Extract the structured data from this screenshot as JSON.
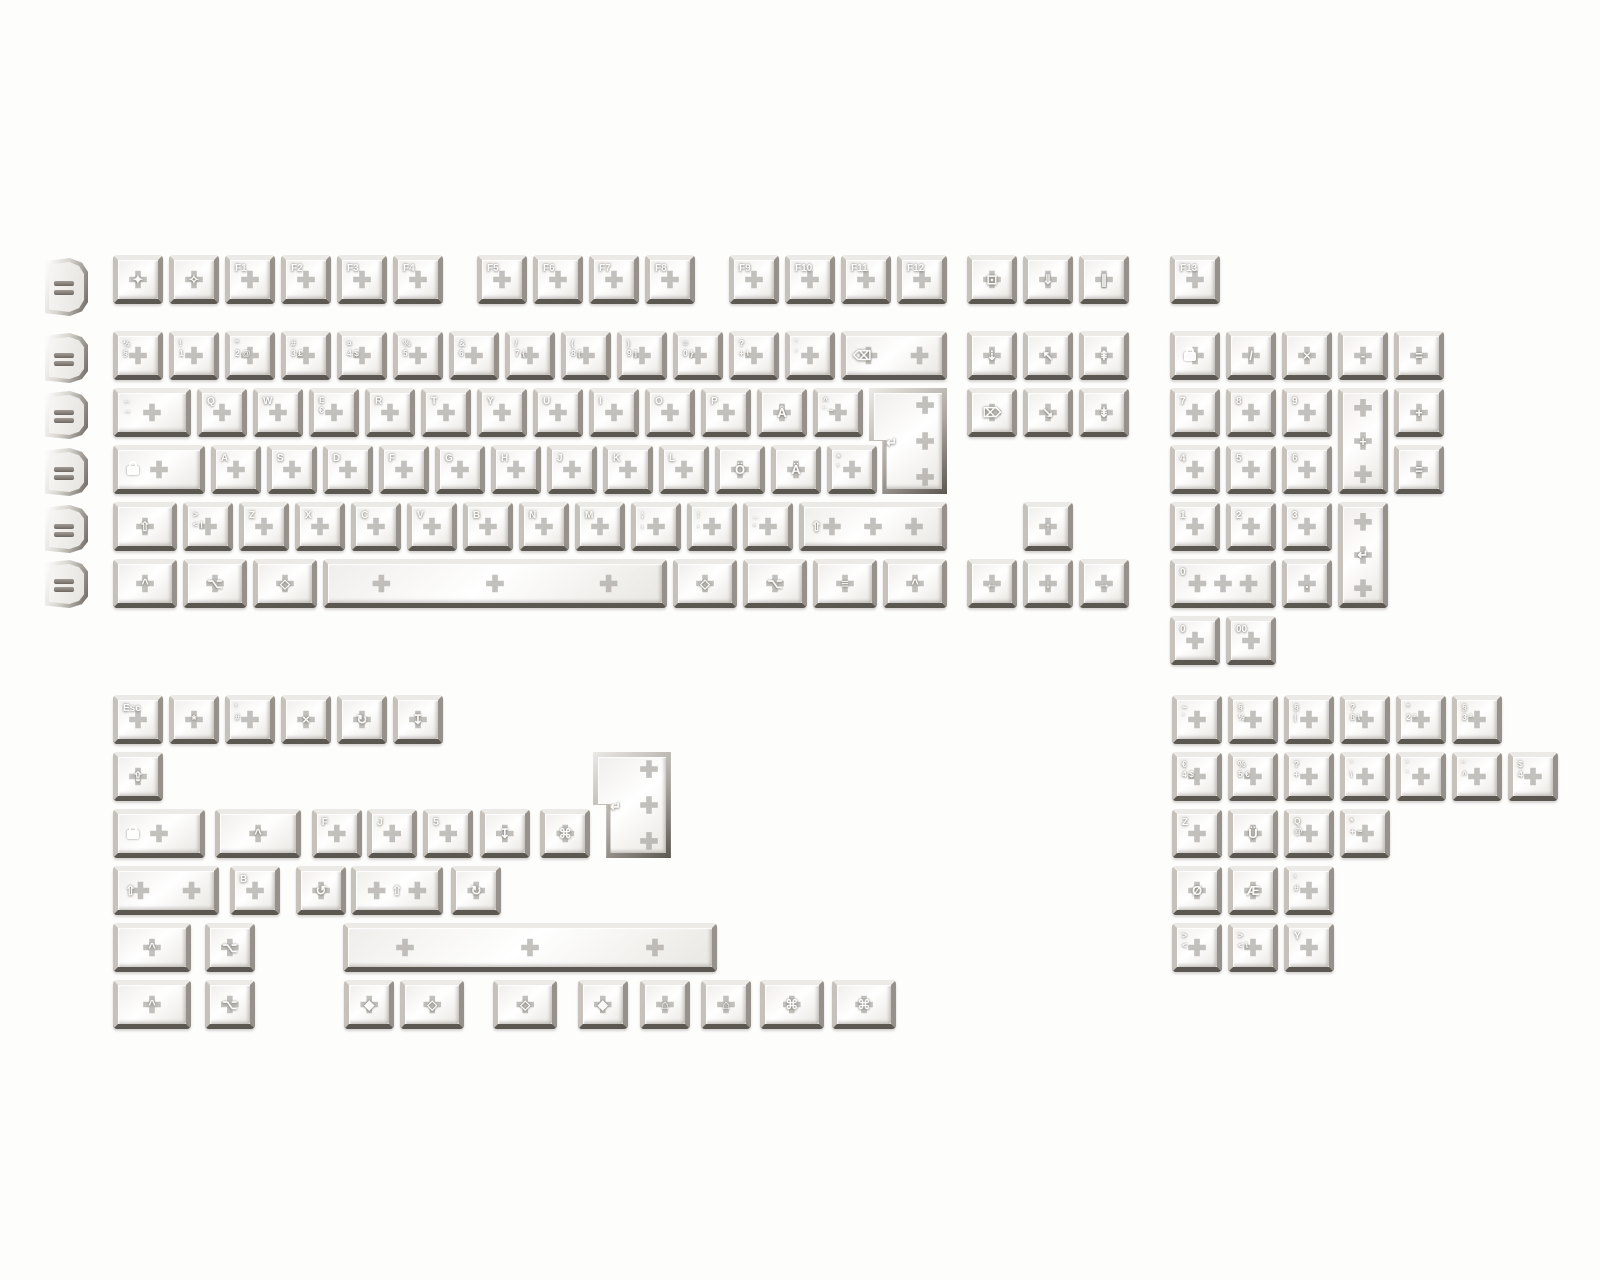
{
  "image": {
    "kind": "keycap-set-product-photo",
    "width": 1600,
    "height": 1280
  },
  "colors": {
    "background": "#fdfdfc",
    "frame_light": "#eceae6",
    "frame_dark": "#5b5751",
    "face": "#ffffff",
    "stem": "#706b64",
    "legend": "#ffffff"
  },
  "unit": 56,
  "row_height": 57,
  "profiles": {
    "name": "keycap-profile-column",
    "x": 45,
    "items": [
      {
        "y": 258,
        "h": 58
      },
      {
        "y": 333,
        "h": 50
      },
      {
        "y": 391,
        "h": 48
      },
      {
        "y": 448,
        "h": 48
      },
      {
        "y": 505,
        "h": 48
      },
      {
        "y": 560,
        "h": 48
      }
    ]
  },
  "blocks": [
    {
      "name": "main-keyboard",
      "x": 113,
      "y": 255,
      "keys": [
        {
          "x": 0,
          "y": 0,
          "l": "✦",
          "n": "esc"
        },
        {
          "x": 1,
          "y": 0,
          "l": "✧",
          "n": "esc-alt"
        },
        {
          "x": 2,
          "y": 0,
          "l": "F1",
          "n": "f1"
        },
        {
          "x": 3,
          "y": 0,
          "l": "F2",
          "n": "f2"
        },
        {
          "x": 4,
          "y": 0,
          "l": "F3",
          "n": "f3"
        },
        {
          "x": 5,
          "y": 0,
          "l": "F4",
          "n": "f4"
        },
        {
          "x": 6.5,
          "y": 0,
          "l": "F5",
          "n": "f5"
        },
        {
          "x": 7.5,
          "y": 0,
          "l": "F6",
          "n": "f6"
        },
        {
          "x": 8.5,
          "y": 0,
          "l": "F7",
          "n": "f7"
        },
        {
          "x": 9.5,
          "y": 0,
          "l": "F8",
          "n": "f8"
        },
        {
          "x": 11,
          "y": 0,
          "l": "F9",
          "n": "f9"
        },
        {
          "x": 12,
          "y": 0,
          "l": "F10",
          "n": "f10"
        },
        {
          "x": 13,
          "y": 0,
          "l": "F11",
          "n": "f11"
        },
        {
          "x": 14,
          "y": 0,
          "l": "F12",
          "n": "f12"
        },
        {
          "x": 0,
          "y": 76,
          "l": "½\n§",
          "n": "half-section"
        },
        {
          "x": 1,
          "y": 76,
          "l": "!\n1",
          "n": "1"
        },
        {
          "x": 2,
          "y": 76,
          "l": "\"\n2 @",
          "n": "2"
        },
        {
          "x": 3,
          "y": 76,
          "l": "#\n3 £",
          "n": "3"
        },
        {
          "x": 4,
          "y": 76,
          "l": "¤\n4 $",
          "n": "4"
        },
        {
          "x": 5,
          "y": 76,
          "l": "%\n5",
          "n": "5"
        },
        {
          "x": 6,
          "y": 76,
          "l": "&\n6",
          "n": "6"
        },
        {
          "x": 7,
          "y": 76,
          "l": "/\n7 {",
          "n": "7"
        },
        {
          "x": 8,
          "y": 76,
          "l": "(\n8 [",
          "n": "8"
        },
        {
          "x": 9,
          "y": 76,
          "l": ")\n9 ]",
          "n": "9"
        },
        {
          "x": 10,
          "y": 76,
          "l": "=\n0 }",
          "n": "0"
        },
        {
          "x": 11,
          "y": 76,
          "l": "?\n+ \\",
          "n": "plus"
        },
        {
          "x": 12,
          "y": 76,
          "l": "`\n´",
          "n": "acute"
        },
        {
          "x": 13,
          "y": 76,
          "w": 2,
          "l": "⌫",
          "n": "backspace",
          "s": 2
        },
        {
          "x": 0,
          "y": 133,
          "w": 1.5,
          "l": "←\n→",
          "n": "tab"
        },
        {
          "x": 1.5,
          "y": 133,
          "l": "Q",
          "n": "q"
        },
        {
          "x": 2.5,
          "y": 133,
          "l": "W",
          "n": "w"
        },
        {
          "x": 3.5,
          "y": 133,
          "l": "E\n€",
          "n": "e"
        },
        {
          "x": 4.5,
          "y": 133,
          "l": "R",
          "n": "r"
        },
        {
          "x": 5.5,
          "y": 133,
          "l": "T",
          "n": "t"
        },
        {
          "x": 6.5,
          "y": 133,
          "l": "Y",
          "n": "y"
        },
        {
          "x": 7.5,
          "y": 133,
          "l": "U",
          "n": "u"
        },
        {
          "x": 8.5,
          "y": 133,
          "l": "I",
          "n": "i"
        },
        {
          "x": 9.5,
          "y": 133,
          "l": "O",
          "n": "o"
        },
        {
          "x": 10.5,
          "y": 133,
          "l": "P",
          "n": "p"
        },
        {
          "x": 11.5,
          "y": 133,
          "l": "Å",
          "n": "aring"
        },
        {
          "x": 12.5,
          "y": 133,
          "l": "^\n¨ ~",
          "n": "diaeresis"
        },
        {
          "x": 13.5,
          "y": 133,
          "w": 1.5,
          "h": 2,
          "l": "↵",
          "n": "iso-enter",
          "shape": "iso",
          "s": 3
        },
        {
          "x": 0,
          "y": 190,
          "w": 1.75,
          "l": "{lock}",
          "n": "caps-lock"
        },
        {
          "x": 1.75,
          "y": 190,
          "l": "A",
          "n": "a"
        },
        {
          "x": 2.75,
          "y": 190,
          "l": "S",
          "n": "s"
        },
        {
          "x": 3.75,
          "y": 190,
          "l": "D",
          "n": "d"
        },
        {
          "x": 4.75,
          "y": 190,
          "l": "F",
          "n": "f"
        },
        {
          "x": 5.75,
          "y": 190,
          "l": "G",
          "n": "g"
        },
        {
          "x": 6.75,
          "y": 190,
          "l": "H",
          "n": "h"
        },
        {
          "x": 7.75,
          "y": 190,
          "l": "J",
          "n": "j"
        },
        {
          "x": 8.75,
          "y": 190,
          "l": "K",
          "n": "k"
        },
        {
          "x": 9.75,
          "y": 190,
          "l": "L",
          "n": "l"
        },
        {
          "x": 10.75,
          "y": 190,
          "l": "Ö",
          "n": "odiaeresis"
        },
        {
          "x": 11.75,
          "y": 190,
          "l": "Ä",
          "n": "adiaeresis"
        },
        {
          "x": 12.75,
          "y": 190,
          "l": "*\n'",
          "n": "apostrophe"
        },
        {
          "x": 0,
          "y": 247,
          "w": 1.25,
          "l": "⇧",
          "n": "shift-left"
        },
        {
          "x": 1.25,
          "y": 247,
          "l": ">\n< |",
          "n": "less-greater"
        },
        {
          "x": 2.25,
          "y": 247,
          "l": "Z",
          "n": "z"
        },
        {
          "x": 3.25,
          "y": 247,
          "l": "X",
          "n": "x"
        },
        {
          "x": 4.25,
          "y": 247,
          "l": "C",
          "n": "c"
        },
        {
          "x": 5.25,
          "y": 247,
          "l": "V",
          "n": "v"
        },
        {
          "x": 6.25,
          "y": 247,
          "l": "B",
          "n": "b"
        },
        {
          "x": 7.25,
          "y": 247,
          "l": "N",
          "n": "n"
        },
        {
          "x": 8.25,
          "y": 247,
          "l": "M",
          "n": "m"
        },
        {
          "x": 9.25,
          "y": 247,
          "l": ";\n,",
          "n": "comma"
        },
        {
          "x": 10.25,
          "y": 247,
          "l": ":\n.",
          "n": "period"
        },
        {
          "x": 11.25,
          "y": 247,
          "l": "_\n-",
          "n": "minus"
        },
        {
          "x": 12.25,
          "y": 247,
          "w": 2.75,
          "l": "⇧",
          "n": "shift-right",
          "s": 3
        },
        {
          "x": 0,
          "y": 304,
          "w": 1.25,
          "l": "^",
          "n": "ctrl-left"
        },
        {
          "x": 1.25,
          "y": 304,
          "w": 1.25,
          "l": "⌥",
          "n": "win-left"
        },
        {
          "x": 2.5,
          "y": 304,
          "w": 1.25,
          "l": "◇",
          "n": "alt-left"
        },
        {
          "x": 3.75,
          "y": 304,
          "w": 6.25,
          "l": "",
          "n": "spacebar",
          "s": 3
        },
        {
          "x": 10,
          "y": 304,
          "w": 1.25,
          "l": "◇",
          "n": "alt-right"
        },
        {
          "x": 11.25,
          "y": 304,
          "w": 1.25,
          "l": "⌥",
          "n": "fn"
        },
        {
          "x": 12.5,
          "y": 304,
          "w": 1.25,
          "l": "≡",
          "n": "menu"
        },
        {
          "x": 13.75,
          "y": 304,
          "w": 1.25,
          "l": "^",
          "n": "ctrl-right"
        }
      ]
    },
    {
      "name": "nav-cluster",
      "x": 967,
      "y": 255,
      "keys": [
        {
          "x": 0,
          "y": 0,
          "l": "⊡",
          "n": "print-screen"
        },
        {
          "x": 1,
          "y": 0,
          "l": "⇓",
          "n": "scroll-lock"
        },
        {
          "x": 2,
          "y": 0,
          "l": "∥",
          "n": "pause"
        },
        {
          "x": 0,
          "y": 76,
          "l": "⇣",
          "n": "insert"
        },
        {
          "x": 1,
          "y": 76,
          "l": "↖",
          "n": "home"
        },
        {
          "x": 2,
          "y": 76,
          "l": "⇞",
          "n": "page-up"
        },
        {
          "x": 0,
          "y": 133,
          "l": "⌦",
          "n": "delete"
        },
        {
          "x": 1,
          "y": 133,
          "l": "↘",
          "n": "end"
        },
        {
          "x": 2,
          "y": 133,
          "l": "⇟",
          "n": "page-down"
        },
        {
          "x": 1,
          "y": 247,
          "l": "↑",
          "n": "arrow-up"
        },
        {
          "x": 0,
          "y": 304,
          "l": "←",
          "n": "arrow-left"
        },
        {
          "x": 1,
          "y": 304,
          "l": "↓",
          "n": "arrow-down"
        },
        {
          "x": 2,
          "y": 304,
          "l": "→",
          "n": "arrow-right"
        }
      ]
    },
    {
      "name": "numpad",
      "x": 1170,
      "y": 331,
      "keys": [
        {
          "x": 0,
          "y": -76,
          "l": "F13",
          "n": "f13"
        },
        {
          "x": 0,
          "y": 0,
          "l": "{lock}",
          "n": "num-lock"
        },
        {
          "x": 1,
          "y": 0,
          "l": "/",
          "n": "np-divide"
        },
        {
          "x": 2,
          "y": 0,
          "l": "×",
          "n": "np-multiply"
        },
        {
          "x": 3,
          "y": 0,
          "l": "-",
          "n": "np-minus"
        },
        {
          "x": 4,
          "y": 0,
          "l": "=",
          "n": "np-equals"
        },
        {
          "x": 0,
          "y": 57,
          "l": "7",
          "n": "np-7"
        },
        {
          "x": 1,
          "y": 57,
          "l": "8",
          "n": "np-8"
        },
        {
          "x": 2,
          "y": 57,
          "l": "9",
          "n": "np-9"
        },
        {
          "x": 3,
          "y": 57,
          "h": 2,
          "l": "+",
          "n": "np-plus",
          "s": 3
        },
        {
          "x": 4,
          "y": 57,
          "l": "+",
          "n": "np-plus-1u"
        },
        {
          "x": 0,
          "y": 114,
          "l": "4",
          "n": "np-4"
        },
        {
          "x": 1,
          "y": 114,
          "l": "5",
          "n": "np-5"
        },
        {
          "x": 2,
          "y": 114,
          "l": "6",
          "n": "np-6"
        },
        {
          "x": 4,
          "y": 114,
          "l": "=",
          "n": "np-equals-alt"
        },
        {
          "x": 0,
          "y": 171,
          "l": "1",
          "n": "np-1"
        },
        {
          "x": 1,
          "y": 171,
          "l": "2",
          "n": "np-2"
        },
        {
          "x": 2,
          "y": 171,
          "l": "3",
          "n": "np-3"
        },
        {
          "x": 3,
          "y": 171,
          "h": 2,
          "l": "↵",
          "n": "np-enter",
          "s": 3
        },
        {
          "x": 0,
          "y": 228,
          "w": 2,
          "l": "0",
          "n": "np-0",
          "s": 3
        },
        {
          "x": 2,
          "y": 228,
          "l": ".",
          "n": "np-period"
        },
        {
          "x": 0,
          "y": 285,
          "l": "0",
          "n": "np-0-1u"
        },
        {
          "x": 1,
          "y": 285,
          "l": "00",
          "n": "np-00"
        }
      ]
    },
    {
      "name": "extras-left",
      "x": 113,
      "y": 695,
      "keys": [
        {
          "x": 0,
          "y": 0,
          "l": "Esc",
          "n": "esc-text"
        },
        {
          "x": 1,
          "y": 0,
          "l": "*",
          "n": "asterisk-alt"
        },
        {
          "x": 2,
          "y": 0,
          "l": "'\n#",
          "n": "hash"
        },
        {
          "x": 3,
          "y": 0,
          "l": "×",
          "n": "multiply-alt"
        },
        {
          "x": 4,
          "y": 0,
          "l": "↻",
          "n": "cycle-cw"
        },
        {
          "x": 5,
          "y": 0,
          "l": "↧",
          "n": "eject"
        },
        {
          "x": 0,
          "y": 57,
          "l": "⇪",
          "n": "caps-arrow"
        },
        {
          "x": 0,
          "y": 114,
          "w": 1.75,
          "l": "{lock}",
          "n": "caps-lock-alt"
        },
        {
          "x": 1.82,
          "y": 114,
          "w": 1.65,
          "l": "^",
          "n": "ctrl-wide"
        },
        {
          "x": 3.55,
          "y": 114,
          "l": "F",
          "n": "f-homing"
        },
        {
          "x": 4.54,
          "y": 114,
          "l": "J",
          "n": "j-homing"
        },
        {
          "x": 5.54,
          "y": 114,
          "l": "5",
          "n": "5-homing"
        },
        {
          "x": 6.55,
          "y": 114,
          "l": "↧",
          "n": "eject-2"
        },
        {
          "x": 7.63,
          "y": 114,
          "l": "⌘",
          "n": "command-1u"
        },
        {
          "x": 8.57,
          "y": 57,
          "w": 1.5,
          "h": 2,
          "l": "↵",
          "n": "iso-enter-alt",
          "shape": "iso",
          "s": 3
        },
        {
          "x": 0,
          "y": 171,
          "w": 2,
          "l": "⇧",
          "n": "shift-2u",
          "s": 2
        },
        {
          "x": 2.09,
          "y": 171,
          "l": "B",
          "n": "b-alt"
        },
        {
          "x": 3.27,
          "y": 171,
          "l": "↺",
          "n": "cycle-ccw"
        },
        {
          "x": 4.25,
          "y": 171,
          "w": 1.75,
          "l": "⇧",
          "n": "shift-175",
          "s": 2
        },
        {
          "x": 6.04,
          "y": 171,
          "l": "↻",
          "n": "cycle-cw-2"
        },
        {
          "x": 0,
          "y": 228,
          "w": 1.5,
          "l": "^",
          "n": "ctrl-15a"
        },
        {
          "x": 1.64,
          "y": 228,
          "l": "⌥",
          "n": "opt-1ua"
        },
        {
          "x": 4.1,
          "y": 228,
          "w": 6.8,
          "l": "",
          "n": "spacebar-7u",
          "s": 3
        },
        {
          "x": 0,
          "y": 285,
          "w": 1.5,
          "l": "^",
          "n": "ctrl-15b"
        },
        {
          "x": 1.64,
          "y": 285,
          "l": "⌥",
          "n": "opt-1ub"
        },
        {
          "x": 4.13,
          "y": 285,
          "l": "◆",
          "n": "meta-1ua"
        },
        {
          "x": 5.13,
          "y": 285,
          "w": 1.25,
          "l": "◇",
          "n": "alt-125a"
        },
        {
          "x": 6.79,
          "y": 285,
          "w": 1.25,
          "l": "◇",
          "n": "alt-125b"
        },
        {
          "x": 8.3,
          "y": 285,
          "l": "◆",
          "n": "meta-1ub"
        },
        {
          "x": 9.41,
          "y": 285,
          "l": "⌂",
          "n": "os-home-a"
        },
        {
          "x": 10.5,
          "y": 285,
          "l": "⌂",
          "n": "os-home-b"
        },
        {
          "x": 11.55,
          "y": 285,
          "w": 1.25,
          "l": "⌘",
          "n": "command-125a"
        },
        {
          "x": 12.84,
          "y": 285,
          "w": 1.25,
          "l": "⌘",
          "n": "command-125b"
        }
      ]
    },
    {
      "name": "extras-international",
      "x": 1172,
      "y": 695,
      "keys": [
        {
          "x": 0,
          "y": 0,
          "l": "~\n´",
          "n": "tilde-acute"
        },
        {
          "x": 1,
          "y": 0,
          "l": "§\n½",
          "n": "section-half"
        },
        {
          "x": 2,
          "y": 0,
          "l": "§\n|",
          "n": "section-pipe"
        },
        {
          "x": 3,
          "y": 0,
          "l": "?\nß \\",
          "n": "eszett"
        },
        {
          "x": 4,
          "y": 0,
          "l": "\"\n2 ²",
          "n": "2-de"
        },
        {
          "x": 5,
          "y": 0,
          "l": "§\n3 ³",
          "n": "3-de"
        },
        {
          "x": 0,
          "y": 57,
          "l": "€\n4 $",
          "n": "4-alt"
        },
        {
          "x": 1,
          "y": 57,
          "l": "%\n5 €",
          "n": "5-alt"
        },
        {
          "x": 2,
          "y": 57,
          "l": "?\n+",
          "n": "plus-alt"
        },
        {
          "x": 3,
          "y": 57,
          "l": "`\n\\",
          "n": "backslash-alt"
        },
        {
          "x": 4,
          "y": 57,
          "l": "´\n`",
          "n": "grave-alt"
        },
        {
          "x": 5,
          "y": 57,
          "l": "¨\n^",
          "n": "circumflex-alt"
        },
        {
          "x": 6,
          "y": 57,
          "l": "$\n4",
          "n": "4-alt2"
        },
        {
          "x": 0,
          "y": 114,
          "l": "Z",
          "n": "z-alt"
        },
        {
          "x": 1,
          "y": 114,
          "l": "Ü",
          "n": "udiaeresis"
        },
        {
          "x": 2,
          "y": 114,
          "l": "Q\n@",
          "n": "q-alt"
        },
        {
          "x": 3,
          "y": 114,
          "l": "*\n+ ~",
          "n": "plus-asterisk"
        },
        {
          "x": 0,
          "y": 171,
          "l": "Ø",
          "n": "oslash"
        },
        {
          "x": 1,
          "y": 171,
          "l": "Æ",
          "n": "ae"
        },
        {
          "x": 2,
          "y": 171,
          "l": "'\n#",
          "n": "hash-alt"
        },
        {
          "x": 0,
          "y": 228,
          "l": ">\n<",
          "n": "iso-angle"
        },
        {
          "x": 1,
          "y": 228,
          "l": ">\n< \\",
          "n": "iso-angle-bs"
        },
        {
          "x": 2,
          "y": 228,
          "l": "Y",
          "n": "y-alt"
        }
      ]
    }
  ]
}
